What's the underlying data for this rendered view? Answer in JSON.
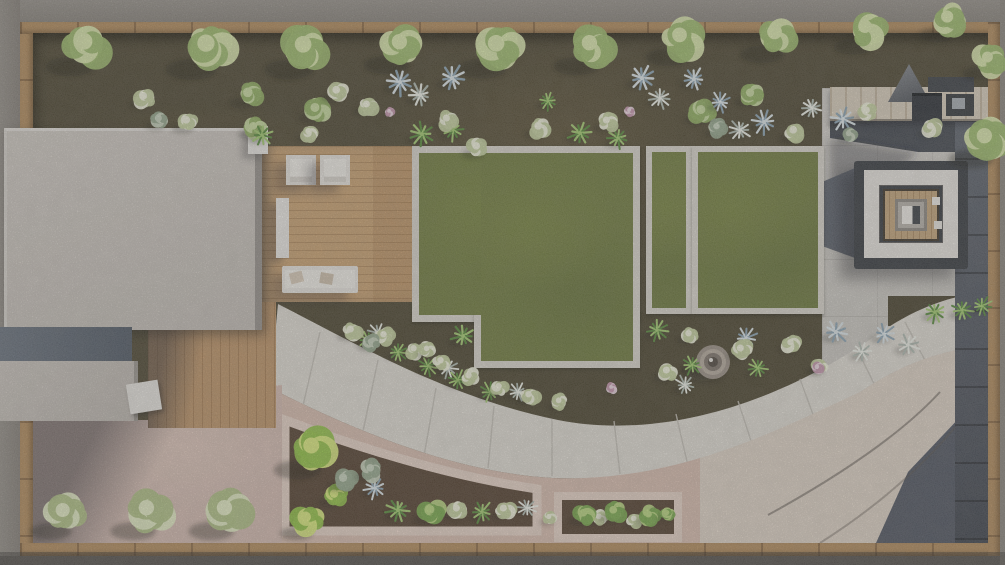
{
  "scene": {
    "description": "Top-down 3D architectural render of a residential backyard landscape design: house roof and wood deck on the left, three bordered lawn panels in the middle, fire-pit lounge and outdoor kitchen on a concrete patio at the right, a wide curved concrete walkway sweeping through planting beds with a round stone fountain, pink gravel patios and dense shrub planters along the bottom, all enclosed by a tan wood fence with gray gravel outside.",
    "visible_text": ""
  },
  "palette": {
    "gravelOuter": "#8d8780",
    "fence": "#b28b5c",
    "soil": "#4d4631",
    "lawn": "#6f7b3d",
    "lawnBorder": "#dad6cd",
    "deck": "#c9a171",
    "deckDark": "#bd9366",
    "roof": "#c8c2bb",
    "roofDark": "#5d6571",
    "path": "#e0dcd4",
    "pinkGravel": "#d3bab0",
    "pinkConcrete": "#e6d2c6",
    "patio": "#d0cdc7",
    "pavingDark": "#565c66",
    "charcoal": "#35393f",
    "cushion": "#e9e6e0",
    "woodInner": "#c4a57b",
    "counter": "#d9cebc",
    "beigeFan": "#ded2c5"
  },
  "plant_colors": {
    "tree": [
      "#9cb96a",
      "#dbe8ad"
    ],
    "treeS": [
      "#8fae5f",
      "#c9dba0"
    ],
    "bushW": [
      "#c3cf9d",
      "#f1f2dd"
    ],
    "bushL": [
      "#aebf83",
      "#e4ecc4"
    ],
    "bushG": [
      "#76a74a",
      "#b9d67f"
    ],
    "bushY": [
      "#8fc043",
      "#dcec7d"
    ],
    "sage": [
      "#93a58b",
      "#c6d1bc"
    ],
    "agave": [
      "#8aa3b3",
      "#dce6ea"
    ],
    "agaveW": [
      "#aeb9b0",
      "#eef1e9"
    ],
    "palm": [
      "#55893a",
      "#a3cb70"
    ],
    "flower": [
      "#c393ab",
      "#ecd7e2"
    ]
  },
  "plants": [
    [
      "tree",
      88,
      46,
      26
    ],
    [
      "tree",
      210,
      48,
      27
    ],
    [
      "tree",
      307,
      49,
      26
    ],
    [
      "tree",
      403,
      46,
      24
    ],
    [
      "tree",
      500,
      48,
      26
    ],
    [
      "tree",
      593,
      47,
      24
    ],
    [
      "tree",
      683,
      39,
      23
    ],
    [
      "tree",
      778,
      36,
      23
    ],
    [
      "tree",
      868,
      30,
      21
    ],
    [
      "tree",
      950,
      20,
      19
    ],
    [
      "tree",
      990,
      60,
      17
    ],
    [
      "tree",
      988,
      140,
      24
    ],
    [
      "treeS",
      250,
      95,
      15
    ],
    [
      "treeS",
      317,
      110,
      14
    ],
    [
      "treeS",
      703,
      112,
      14
    ],
    [
      "treeS",
      752,
      95,
      13
    ],
    [
      "treeS",
      255,
      128,
      12
    ],
    [
      "agave",
      400,
      82,
      12
    ],
    [
      "agave",
      452,
      78,
      12
    ],
    [
      "agave",
      642,
      78,
      12
    ],
    [
      "agave",
      694,
      79,
      11
    ],
    [
      "agave",
      720,
      102,
      10
    ],
    [
      "agave",
      764,
      122,
      11
    ],
    [
      "agave",
      843,
      119,
      11
    ],
    [
      "agave",
      746,
      338,
      10
    ],
    [
      "agave",
      836,
      332,
      11
    ],
    [
      "agave",
      884,
      334,
      10
    ],
    [
      "agave",
      375,
      488,
      10
    ],
    [
      "agaveW",
      420,
      95,
      11
    ],
    [
      "agaveW",
      660,
      98,
      10
    ],
    [
      "agaveW",
      740,
      130,
      10
    ],
    [
      "agaveW",
      812,
      108,
      10
    ],
    [
      "agaveW",
      378,
      333,
      9
    ],
    [
      "agaveW",
      448,
      368,
      9
    ],
    [
      "agaveW",
      518,
      392,
      9
    ],
    [
      "agaveW",
      685,
      385,
      9
    ],
    [
      "agaveW",
      908,
      345,
      10
    ],
    [
      "agaveW",
      862,
      352,
      9
    ],
    [
      "agaveW",
      527,
      508,
      9
    ],
    [
      "palm",
      422,
      134,
      11
    ],
    [
      "palm",
      453,
      130,
      10
    ],
    [
      "palm",
      580,
      133,
      11
    ],
    [
      "palm",
      618,
      138,
      10
    ],
    [
      "palm",
      262,
      135,
      10
    ],
    [
      "palm",
      935,
      312,
      10
    ],
    [
      "palm",
      962,
      310,
      10
    ],
    [
      "palm",
      982,
      306,
      9
    ],
    [
      "palm",
      463,
      336,
      11
    ],
    [
      "palm",
      368,
      340,
      9
    ],
    [
      "palm",
      398,
      352,
      9
    ],
    [
      "palm",
      428,
      366,
      9
    ],
    [
      "palm",
      458,
      380,
      9
    ],
    [
      "palm",
      490,
      392,
      9
    ],
    [
      "palm",
      657,
      330,
      10
    ],
    [
      "palm",
      692,
      365,
      9
    ],
    [
      "palm",
      758,
      368,
      9
    ],
    [
      "palm",
      398,
      510,
      11
    ],
    [
      "palm",
      482,
      512,
      10
    ],
    [
      "palm",
      548,
      101,
      9
    ],
    [
      "bushW",
      145,
      98,
      12
    ],
    [
      "bushW",
      188,
      122,
      12
    ],
    [
      "bushW",
      338,
      92,
      12
    ],
    [
      "bushW",
      368,
      106,
      11
    ],
    [
      "bushW",
      448,
      120,
      11
    ],
    [
      "bushW",
      478,
      148,
      12
    ],
    [
      "bushW",
      540,
      128,
      12
    ],
    [
      "bushW",
      608,
      122,
      11
    ],
    [
      "bushW",
      795,
      132,
      12
    ],
    [
      "bushW",
      868,
      112,
      11
    ],
    [
      "bushW",
      932,
      128,
      11
    ],
    [
      "bushW",
      310,
      133,
      10
    ],
    [
      "bushW",
      352,
      331,
      11
    ],
    [
      "bushW",
      385,
      336,
      10
    ],
    [
      "bushW",
      415,
      350,
      10
    ],
    [
      "bushW",
      442,
      362,
      10
    ],
    [
      "bushW",
      470,
      377,
      10
    ],
    [
      "bushW",
      500,
      388,
      10
    ],
    [
      "bushW",
      530,
      396,
      10
    ],
    [
      "bushW",
      560,
      402,
      9
    ],
    [
      "bushW",
      668,
      372,
      11
    ],
    [
      "bushW",
      742,
      350,
      11
    ],
    [
      "bushW",
      792,
      344,
      10
    ],
    [
      "bushW",
      820,
      366,
      9
    ],
    [
      "bushW",
      690,
      335,
      10
    ],
    [
      "bushW",
      458,
      510,
      11
    ],
    [
      "bushW",
      505,
      510,
      11
    ],
    [
      "bushW",
      550,
      518,
      8
    ],
    [
      "bushW",
      600,
      518,
      9
    ],
    [
      "bushW",
      635,
      520,
      9
    ],
    [
      "bushW",
      428,
      350,
      9
    ],
    [
      "bushG",
      432,
      512,
      14
    ],
    [
      "bushG",
      585,
      515,
      12
    ],
    [
      "bushG",
      615,
      512,
      12
    ],
    [
      "bushG",
      650,
      516,
      11
    ],
    [
      "bushG",
      668,
      514,
      8
    ],
    [
      "bushY",
      315,
      450,
      25
    ],
    [
      "bushY",
      308,
      520,
      17
    ],
    [
      "bushY",
      336,
      496,
      13
    ],
    [
      "sage",
      160,
      120,
      11
    ],
    [
      "sage",
      718,
      128,
      10
    ],
    [
      "sage",
      345,
      480,
      13
    ],
    [
      "sage",
      372,
      470,
      12
    ],
    [
      "sage",
      372,
      343,
      9
    ],
    [
      "sage",
      850,
      135,
      9
    ],
    [
      "flower",
      390,
      112,
      6
    ],
    [
      "flower",
      630,
      111,
      6
    ],
    [
      "flower",
      818,
      368,
      7
    ],
    [
      "flower",
      612,
      388,
      6
    ],
    [
      "bushL",
      66,
      514,
      22
    ],
    [
      "bushL",
      150,
      512,
      24
    ],
    [
      "bushL",
      228,
      512,
      24
    ]
  ],
  "zones": [
    "perimeter-gravel",
    "wood-fence",
    "soil-planting-bed",
    "house-roof",
    "wood-deck",
    "lawn-panel-large",
    "lawn-panel-strip",
    "lawn-panel-right",
    "curved-concrete-path",
    "pink-gravel-patio",
    "outdoor-kitchen",
    "fire-pit-lounge",
    "stone-fountain",
    "curved-planter-bed",
    "rectangular-planter-bed",
    "dark-paver-walkway"
  ]
}
